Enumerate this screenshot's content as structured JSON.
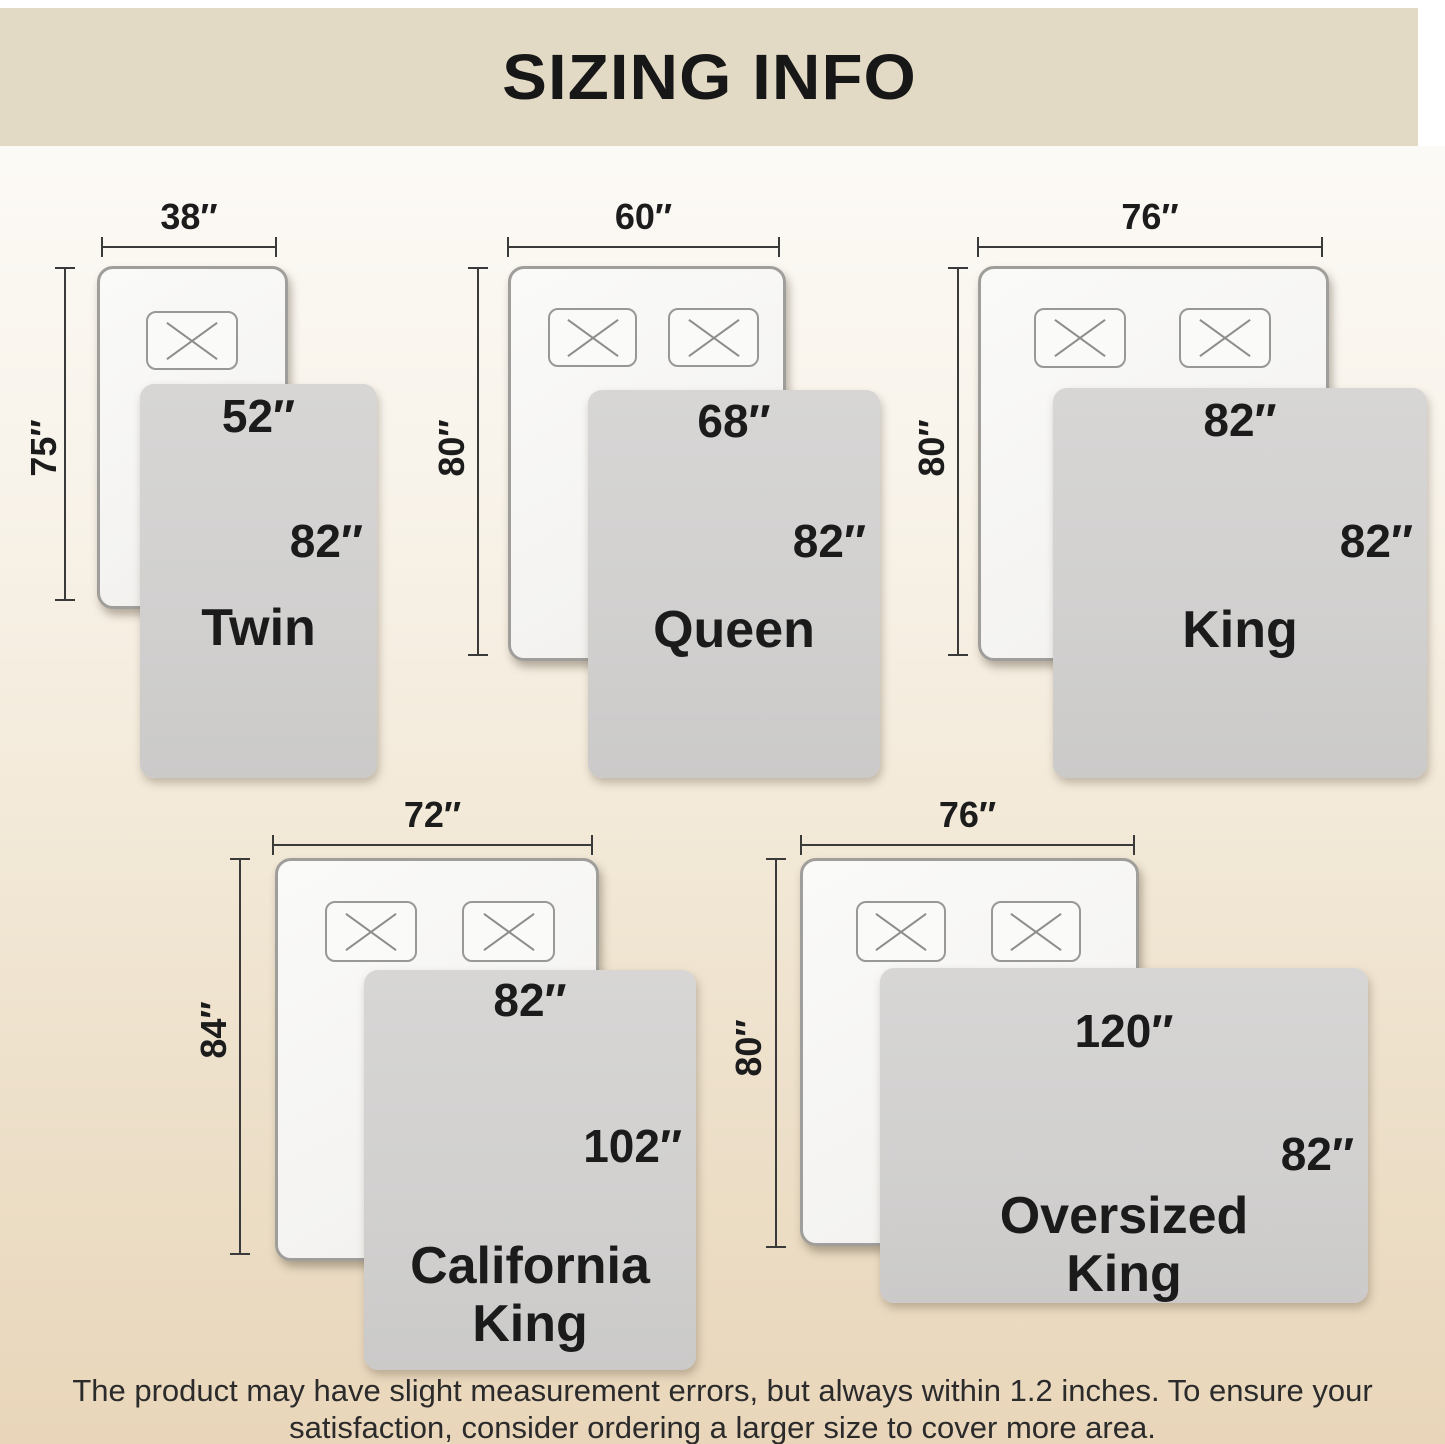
{
  "title": "SIZING INFO",
  "beds": [
    {
      "name_line1": "Twin",
      "name_line2": "",
      "mattress_width": "38″",
      "mattress_length": "75″",
      "blanket_width": "52″",
      "blanket_length": "82″"
    },
    {
      "name_line1": "Queen",
      "name_line2": "",
      "mattress_width": "60″",
      "mattress_length": "80″",
      "blanket_width": "68″",
      "blanket_length": "82″"
    },
    {
      "name_line1": "King",
      "name_line2": "",
      "mattress_width": "76″",
      "mattress_length": "80″",
      "blanket_width": "82″",
      "blanket_length": "82″"
    },
    {
      "name_line1": "California",
      "name_line2": "King",
      "mattress_width": "72″",
      "mattress_length": "84″",
      "blanket_width": "82″",
      "blanket_length": "102″"
    },
    {
      "name_line1": "Oversized",
      "name_line2": "King",
      "mattress_width": "76″",
      "mattress_length": "80″",
      "blanket_width": "120″",
      "blanket_length": "82″"
    }
  ],
  "footer": {
    "line1": "The product may have slight measurement errors, but always within 1.2 inches. To ensure your",
    "line2": "satisfaction, consider ordering a larger size to cover more area."
  },
  "icons": {
    "pillow_mark": "x-mark"
  },
  "colors": {
    "header_bg": "#e3dac6",
    "background_top": "#fcfaf6",
    "background_bottom": "#e9d6ba",
    "blanket": "#d2d1d0",
    "text": "#1b1b1b"
  }
}
